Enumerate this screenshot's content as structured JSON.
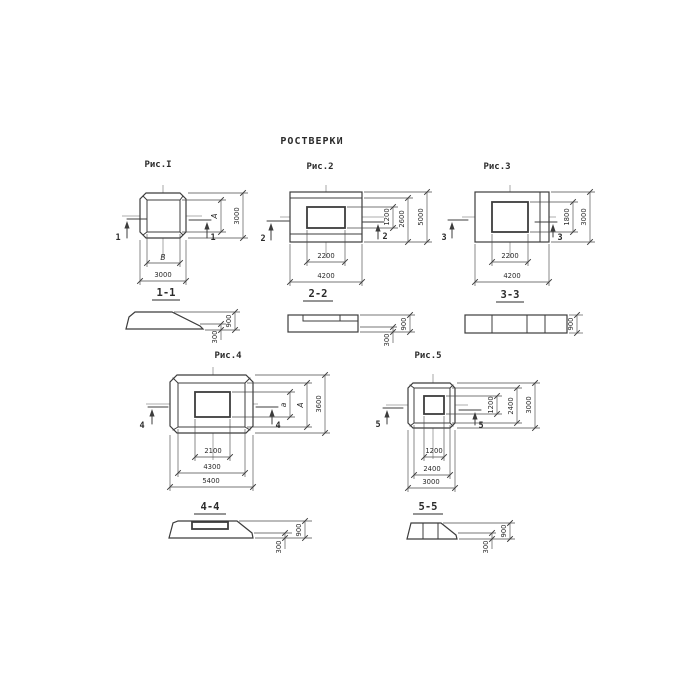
{
  "title": "РОСТВЕРКИ",
  "colors": {
    "ink": "#3c3c3c",
    "background": "#ffffff"
  },
  "figures": [
    {
      "name": "Рис.I",
      "section": "1-1",
      "mark": "1",
      "plan_dims": {
        "bottom": [
          "B",
          "3000"
        ],
        "right": [
          "A",
          "3000"
        ]
      },
      "section_dims": {
        "height": "900",
        "step": "300"
      }
    },
    {
      "name": "Рис.2",
      "section": "2-2",
      "mark": "2",
      "plan_dims": {
        "bottom": [
          "2200",
          "4200"
        ],
        "right": [
          "1200",
          "2600",
          "5000"
        ]
      },
      "section_dims": {
        "height": "900",
        "step": "300"
      }
    },
    {
      "name": "Рис.3",
      "section": "3-3",
      "mark": "3",
      "plan_dims": {
        "bottom": [
          "2200",
          "4200"
        ],
        "right": [
          "1800",
          "3000"
        ]
      },
      "section_dims": {
        "height": "900"
      }
    },
    {
      "name": "Рис.4",
      "section": "4-4",
      "mark": "4",
      "plan_dims": {
        "bottom": [
          "2100",
          "4300",
          "5400"
        ],
        "right": [
          "a",
          "A",
          "3600"
        ]
      },
      "section_dims": {
        "height": "900",
        "step": "300"
      }
    },
    {
      "name": "Рис.5",
      "section": "5-5",
      "mark": "5",
      "plan_dims": {
        "bottom": [
          "1200",
          "2400",
          "3000"
        ],
        "right": [
          "1200",
          "2400",
          "3000"
        ]
      },
      "section_dims": {
        "height": "900",
        "step": "300"
      }
    }
  ]
}
